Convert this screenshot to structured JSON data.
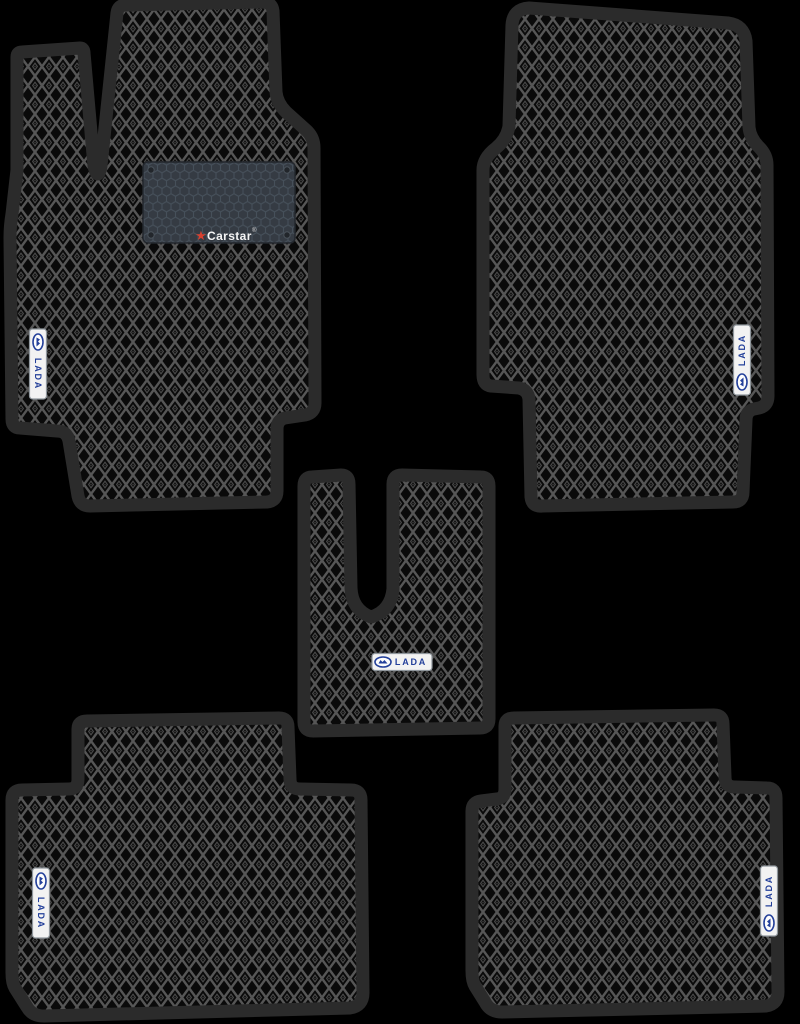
{
  "colors": {
    "background": "#000000",
    "mat_trim": "#2b2b2b",
    "pattern_lattice": "#565656",
    "pattern_cell": "#0a0a0a",
    "pattern_inner": "#4a4a4a",
    "pattern_dot": "#3f3f3f",
    "heel_pad_base": "#353b43",
    "heel_pad_hex": "#46505a",
    "badge_background": "#f2f2f2",
    "lada_blue": "#24409a",
    "carstar_red": "#d8402f"
  },
  "badge": {
    "label": "LADA"
  },
  "heel_pad": {
    "brand": "Carstar",
    "registered_mark": "®",
    "star_glyph": "★"
  },
  "mats": [
    {
      "id": "front-driver"
    },
    {
      "id": "front-passenger"
    },
    {
      "id": "center-tunnel"
    },
    {
      "id": "rear-left"
    },
    {
      "id": "rear-right"
    }
  ]
}
